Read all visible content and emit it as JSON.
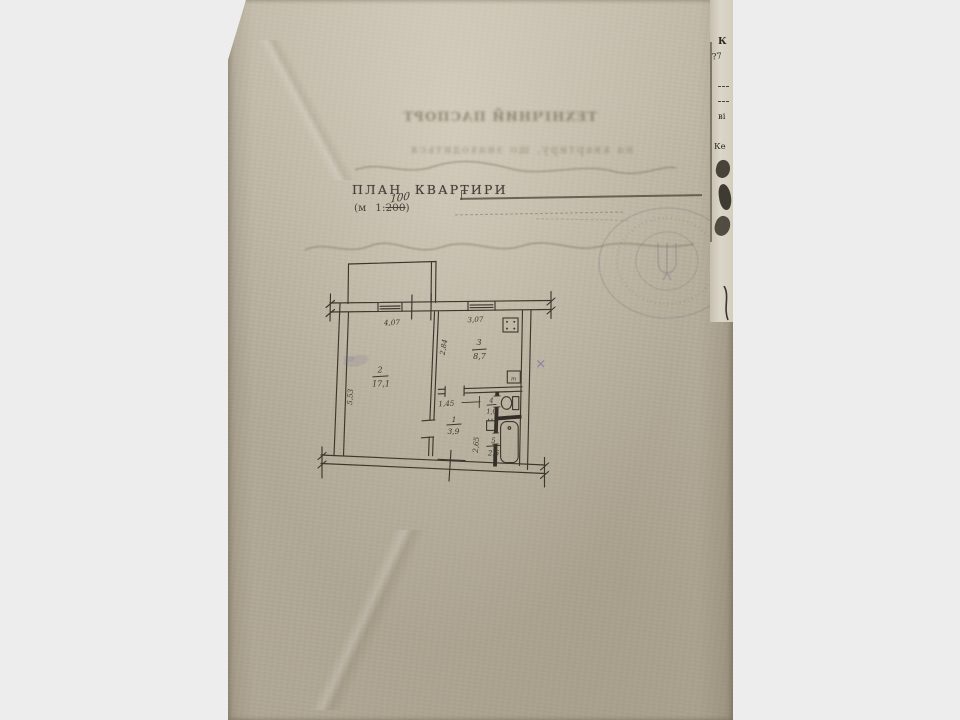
{
  "document": {
    "bleed_title": "ТЕХНІЧНИЙ ПАСПОРТ",
    "bleed_subtitle": "на квартиру, що знаходиться",
    "title": "ПЛАН  КВАРТИРИ",
    "scale_open": "(м",
    "scale_ratio_prefix": "1:",
    "scale_crossed": "200",
    "scale_close": ")",
    "scale_handwritten": "100"
  },
  "plan": {
    "dims": {
      "width_left": "4,07",
      "width_right": "3,07",
      "height_left": "5,53",
      "kitchen_height": "2,84",
      "hall_width": "1,45",
      "bath_height": "2,65"
    },
    "rooms": [
      {
        "number": "2",
        "area": "17,1"
      },
      {
        "number": "3",
        "area": "8,7"
      },
      {
        "number": "1",
        "area": "3,9"
      },
      {
        "number": "4",
        "area": "1,0"
      },
      {
        "number": "5",
        "area": "2,6"
      }
    ],
    "sink_mark": "т"
  },
  "side_page": {
    "fragments": [
      "К",
      "?7",
      "ві",
      "Ке"
    ]
  },
  "colors": {
    "paper": "#b9b1a0",
    "ink": "#3b372c",
    "background": "#ededed",
    "stamp": "#6c6478"
  }
}
